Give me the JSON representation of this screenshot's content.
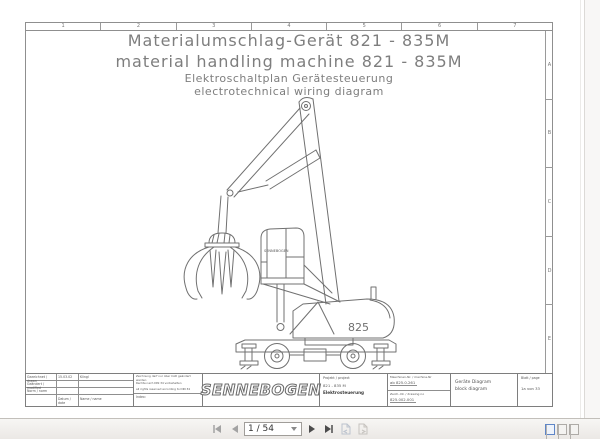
{
  "viewer": {
    "toolbar": {
      "page_value": "1 / 54",
      "icons": [
        "first-page",
        "previous-page",
        "next-page",
        "last-page",
        "previous-view",
        "next-view"
      ],
      "layout_icons": [
        "single-page-view",
        "continuous-view",
        "two-page-view"
      ],
      "accent_blue": "#5f86c7"
    }
  },
  "drawing": {
    "frame": {
      "columns": [
        "1",
        "2",
        "3",
        "4",
        "5",
        "6",
        "7"
      ],
      "rows": [
        "A",
        "B",
        "C",
        "D",
        "E"
      ]
    },
    "title": {
      "line1": "Materialumschlag-Gerät 821 - 835M",
      "line2": "material handling machine 821 - 835M",
      "line3": "Elektroschaltplan Gerätesteuerung",
      "line4": "electrotechnical wiring diagram"
    },
    "machine_label": "825",
    "cab_brand": "SENNEBOGEN",
    "title_block": {
      "drawn_label": "Gezeichnet / drawn",
      "drawn_date": "15.03.02",
      "drawn_name": "Klingl",
      "modified_label": "Geändert / modified",
      "norm_label": "Norm / norm",
      "date_label": "Datum / date",
      "name_label": "Name / name",
      "notice_line1": "Zeichnung darf nur über CAD geändert werden",
      "notice_line2": "Rechte nach DIN 34 vorbehalten",
      "notice_line3": "all rights reserved according to DIN 34",
      "index_label": "Index:",
      "logo_text": "SENNEBOGEN",
      "project_label": "Projekt / project",
      "project_value": "821 - 835 M",
      "project_sub": "Elektrosteuerung",
      "machine_nr_label": "Maschinen-Nr. / machine-Nr",
      "machine_nr_value": "ab 825.0.261",
      "drawing_nr_label": "Zeich.-Nr. / drawing no",
      "drawing_nr_value": "825.002.001",
      "doc_title_de": "Geräte Diagram",
      "doc_title_en": "block diagram",
      "page_label": "Blatt / page",
      "page_value": "1a von 33"
    }
  }
}
